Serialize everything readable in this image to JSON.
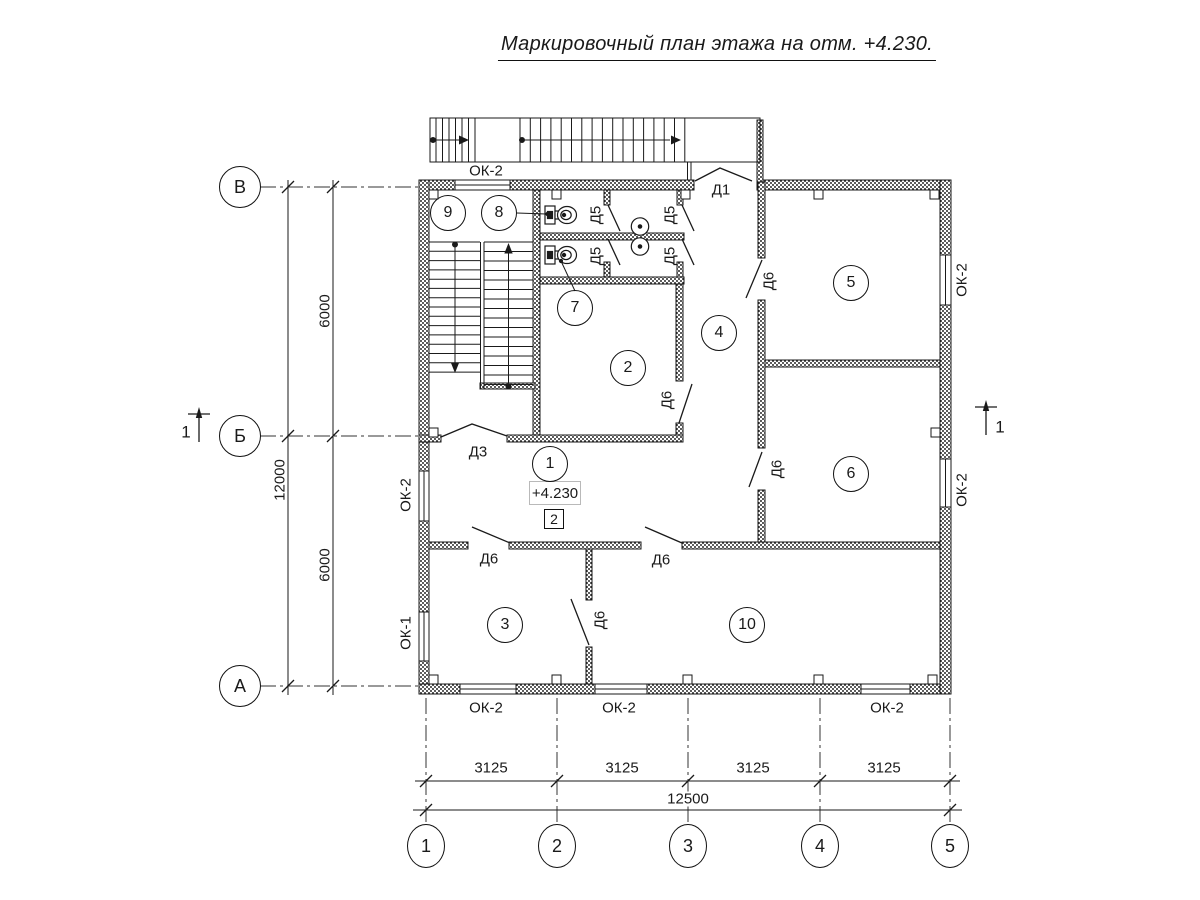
{
  "title": "Маркировочный план этажа на отм. +4.230.",
  "elevation": {
    "value": "+4.230",
    "marker": "2"
  },
  "rooms": [
    {
      "n": "1",
      "x": 550,
      "y": 464
    },
    {
      "n": "2",
      "x": 628,
      "y": 368
    },
    {
      "n": "3",
      "x": 505,
      "y": 625
    },
    {
      "n": "4",
      "x": 719,
      "y": 333
    },
    {
      "n": "5",
      "x": 851,
      "y": 283
    },
    {
      "n": "6",
      "x": 851,
      "y": 474
    },
    {
      "n": "7",
      "x": 575,
      "y": 308
    },
    {
      "n": "8",
      "x": 499,
      "y": 213
    },
    {
      "n": "9",
      "x": 448,
      "y": 213
    },
    {
      "n": "10",
      "x": 747,
      "y": 625
    }
  ],
  "grid": {
    "rows": [
      {
        "label": "В",
        "x": 240,
        "y": 187
      },
      {
        "label": "Б",
        "x": 240,
        "y": 436
      },
      {
        "label": "А",
        "x": 240,
        "y": 686
      }
    ],
    "cols": [
      {
        "label": "1",
        "x": 426,
        "y": 846
      },
      {
        "label": "2",
        "x": 557,
        "y": 846
      },
      {
        "label": "3",
        "x": 688,
        "y": 846
      },
      {
        "label": "4",
        "x": 820,
        "y": 846
      },
      {
        "label": "5",
        "x": 950,
        "y": 846
      }
    ]
  },
  "dimensions": {
    "vertical": [
      {
        "text": "6000",
        "x": 325,
        "y": 311
      },
      {
        "text": "12000",
        "x": 280,
        "y": 480
      },
      {
        "text": "6000",
        "x": 325,
        "y": 565
      }
    ],
    "horizontal": [
      {
        "text": "3125",
        "x": 491,
        "y": 768
      },
      {
        "text": "3125",
        "x": 622,
        "y": 768
      },
      {
        "text": "3125",
        "x": 753,
        "y": 768
      },
      {
        "text": "3125",
        "x": 884,
        "y": 768
      },
      {
        "text": "12500",
        "x": 688,
        "y": 799
      }
    ]
  },
  "door_labels": [
    {
      "text": "Д1",
      "x": 721,
      "y": 190,
      "rot": false
    },
    {
      "text": "Д3",
      "x": 478,
      "y": 452,
      "rot": false
    },
    {
      "text": "Д5",
      "x": 596,
      "y": 215,
      "rot": true
    },
    {
      "text": "Д5",
      "x": 670,
      "y": 215,
      "rot": true
    },
    {
      "text": "Д5",
      "x": 596,
      "y": 256,
      "rot": true
    },
    {
      "text": "Д5",
      "x": 670,
      "y": 256,
      "rot": true
    },
    {
      "text": "Д6",
      "x": 667,
      "y": 400,
      "rot": true
    },
    {
      "text": "Д6",
      "x": 769,
      "y": 281,
      "rot": true
    },
    {
      "text": "Д6",
      "x": 777,
      "y": 469,
      "rot": true
    },
    {
      "text": "Д6",
      "x": 489,
      "y": 559,
      "rot": false
    },
    {
      "text": "Д6",
      "x": 661,
      "y": 560,
      "rot": false
    },
    {
      "text": "Д6",
      "x": 600,
      "y": 620,
      "rot": true
    }
  ],
  "window_labels": [
    {
      "text": "ОК-2",
      "x": 486,
      "y": 171,
      "rot": false
    },
    {
      "text": "ОК-2",
      "x": 406,
      "y": 495,
      "rot": true
    },
    {
      "text": "ОК-1",
      "x": 406,
      "y": 633,
      "rot": true
    },
    {
      "text": "ОК-2",
      "x": 486,
      "y": 708,
      "rot": false
    },
    {
      "text": "ОК-2",
      "x": 619,
      "y": 708,
      "rot": false
    },
    {
      "text": "ОК-2",
      "x": 887,
      "y": 708,
      "rot": false
    },
    {
      "text": "ОК-2",
      "x": 962,
      "y": 280,
      "rot": true
    },
    {
      "text": "ОК-2",
      "x": 962,
      "y": 490,
      "rot": true
    }
  ],
  "section_marks": [
    {
      "label": "1",
      "x": 186,
      "y": 432
    },
    {
      "label": "1",
      "x": 1000,
      "y": 427
    }
  ]
}
